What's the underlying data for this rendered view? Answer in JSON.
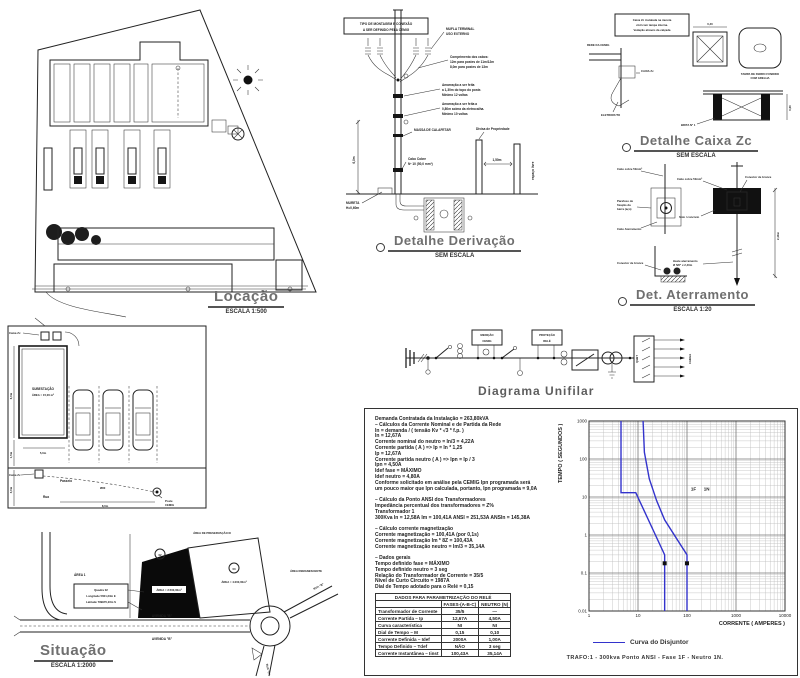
{
  "sheet": {
    "bg": "#ffffff",
    "ink": "#1f1f1f",
    "title_color": "#6f6f6f",
    "curve_blue": "#3333cc"
  },
  "locacao": {
    "title": "Locação",
    "scale": "ESCALA 1:500"
  },
  "planta": {
    "room_line1": "SUBESTAÇÃO",
    "room_line2": "ÁREA = 15,00 m²",
    "caixa_label": "Caixa Zc",
    "caixa_label2": "Caixa Zc",
    "passeio": "Passeio",
    "rua": "Rua",
    "poste_line1": "Poste",
    "poste_line2": "CEMIG",
    "cabo": "Ø80",
    "dim_6m": "6,0m",
    "dim_15m": "1,5m",
    "dim_5m": "5,0m",
    "dim_3m": "3,0m",
    "dim_8m": "8,0m"
  },
  "situacao": {
    "title": "Situação",
    "scale": "ESCALA 1:2000",
    "avenida_top": "AVENIDA \"B\"",
    "avenida_bottom": "AVENIDA \"B\"",
    "rua_b": "RUA \"B\"",
    "rua_c": "RUA \"C\"",
    "area1": "ÁREA 1",
    "area_preservacao": "ÁREA DE PRESERVAÇÃO III",
    "area_remanescente": "ÁREA REMANESCENTE",
    "lote_label": "ÁREA = 2.500,00m²",
    "lote2_label": "ÁREA = 4.000,00m²",
    "marker1": "02",
    "marker2": "03",
    "callout_l1": "Quadra 02",
    "callout_l2": "Longitude 5601,23m E",
    "callout_l3": "Latitude 789970,23m S"
  },
  "derivacao": {
    "title": "Detalhe Derivação",
    "scale": "SEM ESCALA",
    "note_l1": "TIPO DE MONTAGEM E CONEXÃO",
    "note_l2": "A SER DEFINIDO PELA CEMIG",
    "mufla_l1": "MUFLA TERMINAL",
    "mufla_l2": "USO EXTERNO",
    "compr_l1": "Comprimento dos cabos:",
    "compr_l2": "12m para postes de 11m/12m",
    "compr_l3": "8,0m para postes de 13m",
    "amar1_l1": "Amarração a ser feita",
    "amar1_l2": "a 1,30m do topo do poste.",
    "amar1_l3": "Mínimo 12 voltas",
    "amar2_l1": "Amarração a ser feita a",
    "amar2_l2": "0,80m acima da eletrocalha.",
    "amar2_l3": "Mínimo 10 voltas",
    "massa": "MASSA DE CALAFETAR",
    "cabo_l1": "Cabo Cobre",
    "cabo_l2": "Nº 10 (50,0 mm²)",
    "divisa": "Divisa de Propriedade",
    "mureta_l1": "MURETA",
    "mureta_l2": "H=0,60m",
    "espaco": "espaço livre",
    "dim_6m": "6,0m",
    "dim_150": "1,50m"
  },
  "caixa_zc": {
    "title": "Detalhe Caixa Zc",
    "scale": "SEM ESCALA",
    "note_l1": "Caixa Zc instalada na mureta",
    "note_l2": "civil com tampa interna.",
    "note_l3": "Vedação através da calçada",
    "rede": "REDE DA CEMIG",
    "caixa": "CAIXA Zc",
    "eletroduto": "ELETRODUTO",
    "tampa_l1": "TAMPA DE FERRO FUNDIDO",
    "tampa_l2": "COM GRELHA",
    "brita": "BRITA Nº 1",
    "dim_040": "0,40",
    "dim_060": "0,60"
  },
  "aterramento": {
    "title": "Det. Aterramento",
    "scale": "ESCALA 1:20",
    "cabo1": "Cabo cobre 50mm²",
    "parafuso_l1": "Parafuso de",
    "parafuso_l2": "fixação da",
    "parafuso_l3": "barra (aço)",
    "cabo_aterr": "Cabo Aterramento",
    "conector": "Conector de bronze",
    "conector2": "Conector de bronze",
    "cabo2": "Cabo cobre 50mm²",
    "solo": "Solo / concreto",
    "haste_l1": "Haste aterramento",
    "haste_l2": "Ø 5/8\" x 2,40m",
    "dim": "2,40m"
  },
  "unifilar": {
    "title": "Diagrama Unifilar",
    "box1_l1": "MEDIÇÃO",
    "box1_l2": "CEMIG",
    "box2_l1": "PROTEÇÃO",
    "box2_l2": "RELÉ",
    "qgbt": "QGBT",
    "carga": "CARGA"
  },
  "report": {
    "lines": [
      "Demanda Contratada da Instalação = 263,80kVA",
      "–  Cálculos da Corrente Nominal e de Partida da Rede",
      "In = demanda / ( tensão Kv * √3 * f.p. )",
      "In = 12,67A",
      "Corrente nominal do neutro = In/3 = 4,22A",
      "Corrente partida ( A )  =>  Ip = In * 1,25",
      "Ip = 12,67A",
      "Corrente partida neutro ( A )  =>  Ipn = Ip / 3",
      "Ipn = 4,50A",
      "Idef fase = MÁXIMO",
      "Idef neutro = 4,80A",
      "Conforme solicitado em análise pela CEMIG Ipn programada será",
      "um pouco maior que Ipn calculada, portanto, Ipn programada = 9,0A",
      "",
      "–  Cálculo da Ponto ANSI dos Transformadores",
      "Impedância percentual dos transformadores = Z%",
      "Transformador 1",
      "300Kva  In = 12,58A   Im = 100,41A   ANSI = 251,53A   ANSIn = 145,38A",
      "",
      "–  Cálculo corrente magnetização",
      "Corrente magnetização = 100,41A   (por 0,1s)",
      "Corrente magnetização Im * 8Z = 100,43A",
      "Corrente magnetização neutro = Im/3 = 35,14A",
      "",
      "–  Dados gerais",
      "Tempo definido fase = MÁXIMO",
      "Tempo definido neutro = 3 seg",
      "Relação do Transformador de Corrente = 35/5",
      "Nível de Curto Circuito = 1987A",
      "Dial de Tempo adotado para o Relé = 0,15"
    ]
  },
  "rele_table": {
    "title": "DADOS PARA PARAMETRIZAÇÃO DO RELÉ",
    "col0": "",
    "col1": "FASES-(A-B-C)",
    "col2": "NEUTRO (N)",
    "rows": [
      [
        "Transformador de Corrente",
        "35/5",
        "—"
      ],
      [
        "Corrente Partida – Ip",
        "12,67A",
        "4,50A"
      ],
      [
        "Curva característica",
        "NI",
        "NI"
      ],
      [
        "Dial de Tempo – M",
        "0,15",
        "0,10"
      ],
      [
        "Corrente Definida – Idef",
        "2000A",
        "1,00A"
      ],
      [
        "Tempo Definido – Tdef",
        "NÃO",
        "3 seg"
      ],
      [
        "Corrente Instantânea – Iinst",
        "100,43A",
        "35,14A"
      ]
    ]
  },
  "chart_data": {
    "type": "line",
    "title": "Curva do Disjuntor",
    "xlabel": "CORRENTE ( AMPERES )",
    "ylabel": "TEMPO ( SEGUNDOS )",
    "xscale": "log",
    "yscale": "log",
    "xlim": [
      1,
      10000
    ],
    "ylim": [
      0.01,
      1000
    ],
    "xticks": [
      1,
      10,
      100,
      1000,
      10000
    ],
    "yticks": [
      0.01,
      0.1,
      1,
      10,
      100,
      1000
    ],
    "grid": true,
    "legend_label": "Curva do Disjuntor",
    "legend_color": "#3333cc",
    "series": [
      {
        "name": "Curva Neutro",
        "color": "#3333cc",
        "points": [
          [
            4.5,
            1000
          ],
          [
            4.5,
            13
          ],
          [
            9,
            13
          ],
          [
            35,
            0.3
          ],
          [
            35,
            0.01
          ]
        ]
      },
      {
        "name": "Curva Fase",
        "color": "#3333cc",
        "points": [
          [
            12.7,
            1000
          ],
          [
            13.5,
            150
          ],
          [
            17,
            30
          ],
          [
            24,
            8
          ],
          [
            35,
            2.5
          ],
          [
            100,
            0.3
          ],
          [
            100,
            0.01
          ]
        ]
      }
    ],
    "markers": [
      {
        "x": 35,
        "y": 0.18
      },
      {
        "x": 100,
        "y": 0.18
      }
    ],
    "annotations": [
      {
        "x": 120,
        "y": 15,
        "text": "1F"
      },
      {
        "x": 220,
        "y": 15,
        "text": "1N"
      }
    ],
    "footer": "TRAFO:1  -  300kva      Ponto ANSI  -  Fase  1F  -  Neutro  1N."
  }
}
